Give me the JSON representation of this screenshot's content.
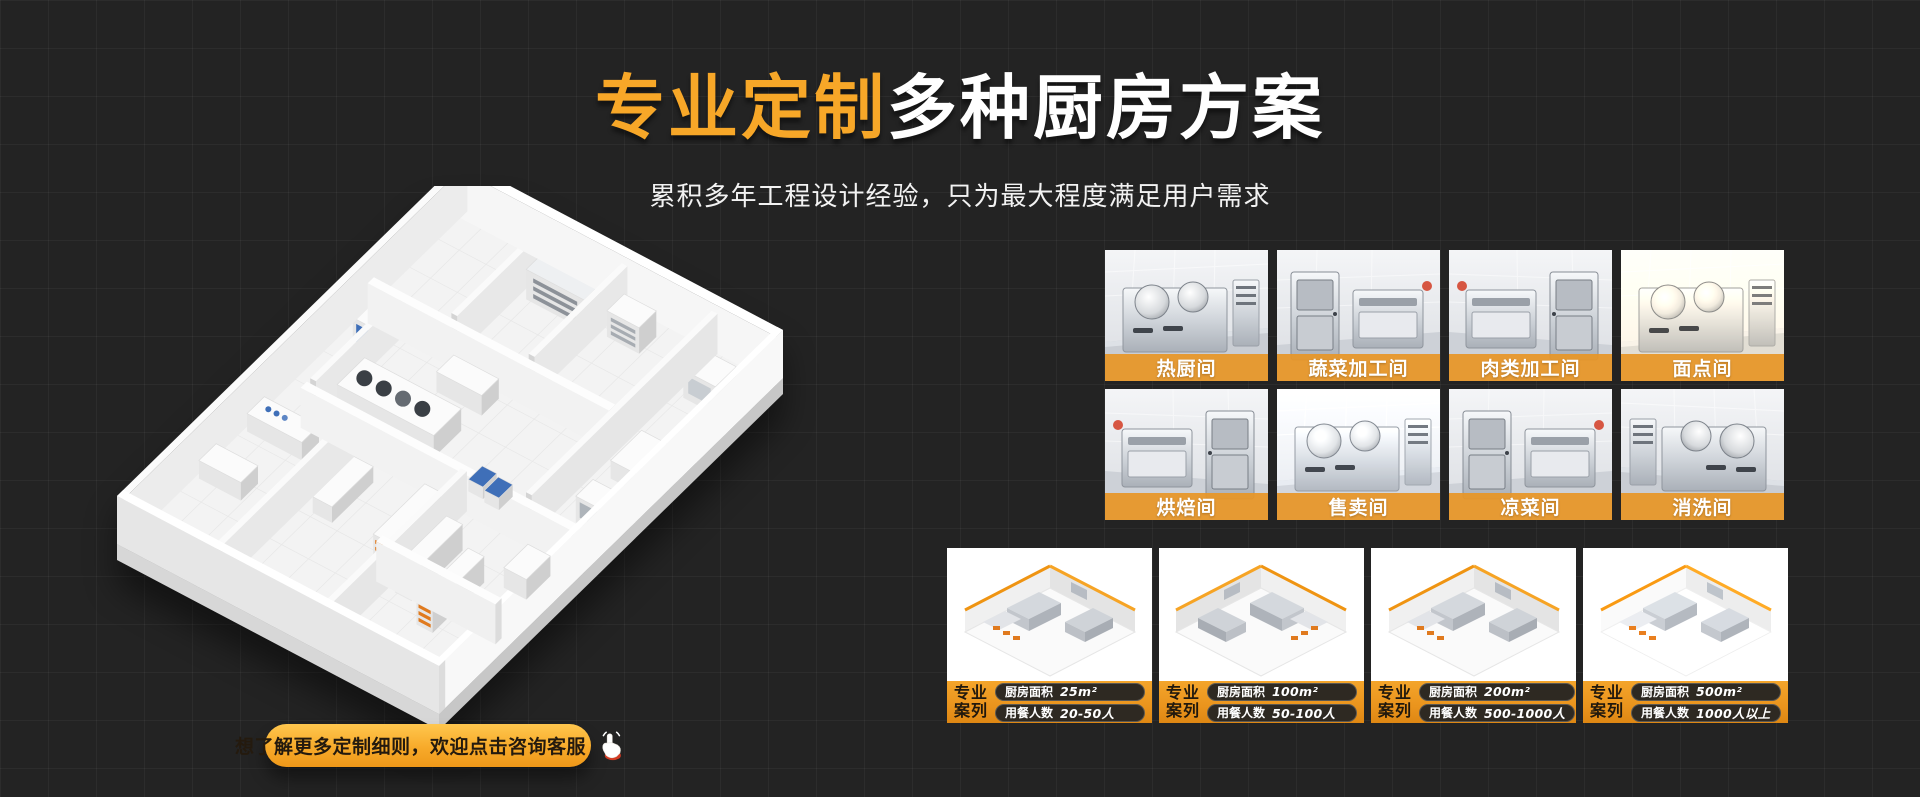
{
  "header": {
    "title_highlight": "专业定制",
    "title_rest": "多种厨房方案",
    "subtitle": "累积多年工程设计经验，只为最大程度满足用户需求"
  },
  "cta": {
    "label": "想了解更多定制细则，欢迎点击咨询客服"
  },
  "rooms": [
    {
      "label": "热厨间"
    },
    {
      "label": "蔬菜加工间"
    },
    {
      "label": "肉类加工间"
    },
    {
      "label": "面点间"
    },
    {
      "label": "烘焙间"
    },
    {
      "label": "售卖间"
    },
    {
      "label": "凉菜间"
    },
    {
      "label": "消洗间"
    }
  ],
  "cases": [
    {
      "tag_line1": "专业",
      "tag_line2": "案列",
      "area_label": "厨房面积",
      "area_value": "25m²",
      "diners_label": "用餐人数",
      "diners_value": "20-50人"
    },
    {
      "tag_line1": "专业",
      "tag_line2": "案列",
      "area_label": "厨房面积",
      "area_value": "100m²",
      "diners_label": "用餐人数",
      "diners_value": "50-100人"
    },
    {
      "tag_line1": "专业",
      "tag_line2": "案列",
      "area_label": "厨房面积",
      "area_value": "200m²",
      "diners_label": "用餐人数",
      "diners_value": "500-1000人"
    },
    {
      "tag_line1": "专业",
      "tag_line2": "案列",
      "area_label": "厨房面积",
      "area_value": "500m²",
      "diners_label": "用餐人数",
      "diners_value": "1000人以上"
    }
  ],
  "colors": {
    "background": "#232323",
    "accent_orange": "#F7A728",
    "room_label_bar": "#E79627",
    "case_bar_top": "#F4A52B",
    "case_bar_bottom": "#DE8713"
  }
}
